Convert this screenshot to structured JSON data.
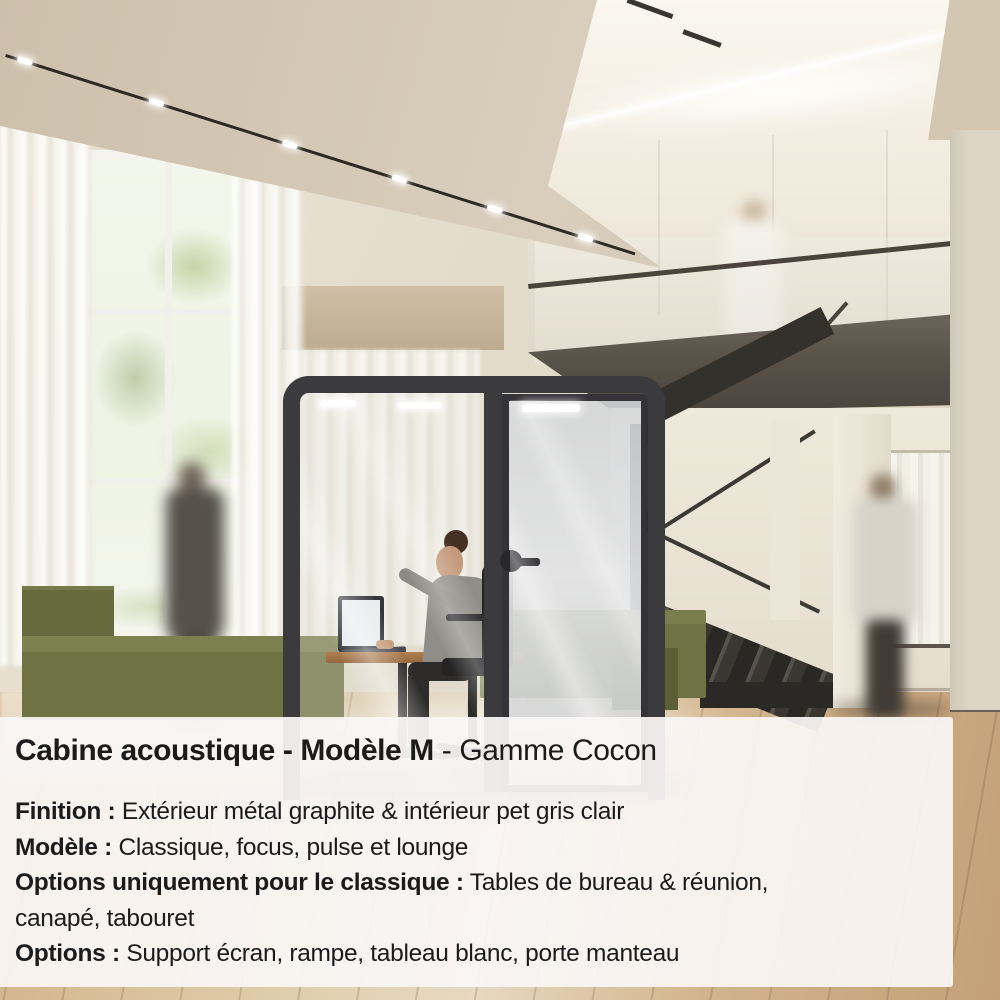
{
  "card": {
    "title": {
      "bold": "Cabine acoustique - Modèle M",
      "regular": " - Gamme Cocon"
    },
    "lines": [
      {
        "bold": "Finition :",
        "text": " Extérieur métal graphite & intérieur pet gris clair"
      },
      {
        "bold": "Modèle :",
        "text": " Classique, focus, pulse et lounge"
      },
      {
        "bold": "Options uniquement pour le classique :",
        "text": " Tables de bureau & réunion,"
      },
      {
        "bold": "",
        "text": "canapé, tabouret"
      },
      {
        "bold": "Options :",
        "text": " Support écran, rampe, tableau blanc, porte manteau"
      }
    ]
  },
  "colors": {
    "booth_graphite": "#3b3a3c",
    "sofa_olive": "#6f7343",
    "wood_floor": "#c9a87f",
    "caption_background": "#faf6f5",
    "caption_text": "#1b1b1b",
    "wall_beige": "#d8cdbb"
  }
}
